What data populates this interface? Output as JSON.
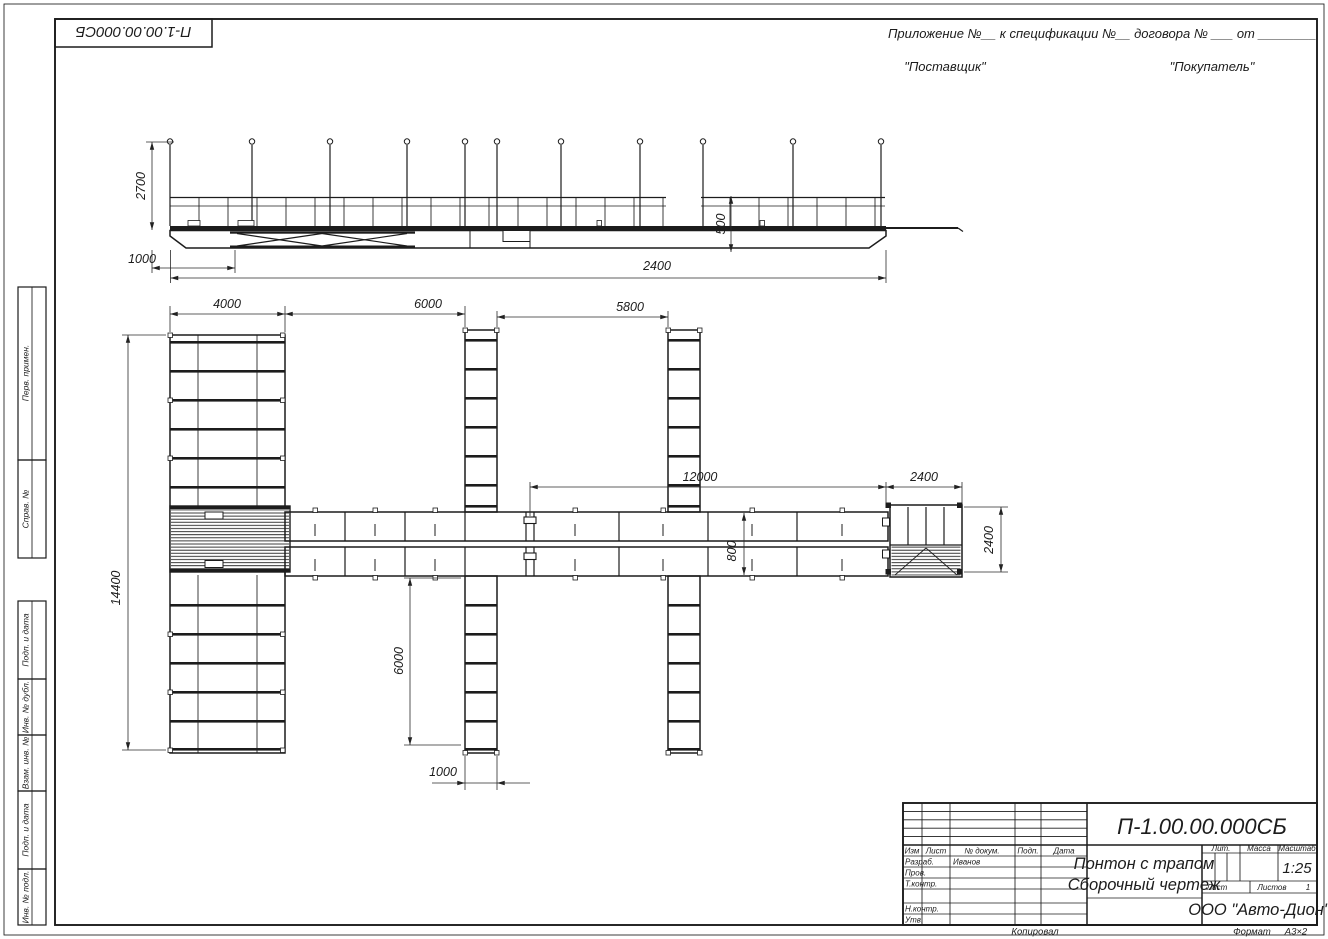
{
  "stamp_top_left": "П-1.00.00.000СБ",
  "header": {
    "line1": "Приложение №__      к спецификации №__    договора № ___  от  ________",
    "supplier": "\"Поставщик\"",
    "buyer": "\"Покупатель\""
  },
  "side_margin": {
    "boxes": [
      {
        "label": "Перв. примен."
      },
      {
        "label": "Справ. №"
      },
      {
        "label": "Подп. и дата"
      },
      {
        "label": "Инв. № дубл."
      },
      {
        "label": "Взам. инв. №"
      },
      {
        "label": "Подп. и дата"
      },
      {
        "label": "Инв. № подл."
      }
    ]
  },
  "dims": {
    "side": {
      "posts_height": "2700",
      "left_offset": "1000",
      "freeboard": "500",
      "total": "2400"
    },
    "plan": {
      "block_width": "4000",
      "gap1": "6000",
      "gap2": "5800",
      "walkway": "12000",
      "end_section": "2400",
      "total_length": "14400",
      "finger_length": "6000",
      "finger_width": "1000",
      "walkway_width": "800",
      "end_width": "2400"
    }
  },
  "title_block": {
    "designation": "П-1.00.00.000СБ",
    "name_line1": "Понтон с трапом",
    "name_line2": "Сборочный чертеж",
    "col_izm": "Изм",
    "col_list": "Лист",
    "col_doc": "№ докум.",
    "col_podp": "Подп.",
    "col_data": "Дата",
    "rows": [
      {
        "label": "Разраб.",
        "value": "Иванов"
      },
      {
        "label": "Пров.",
        "value": ""
      },
      {
        "label": "Т.контр.",
        "value": ""
      },
      {
        "label": "Н.контр.",
        "value": ""
      },
      {
        "label": "Утв.",
        "value": ""
      }
    ],
    "lit_label": "Лит.",
    "mass_label": "Масса",
    "scale_label": "Масштаб",
    "scale_value": "1:25",
    "sheet_label": "Лист",
    "sheets_label": "Листов",
    "sheets_value": "1",
    "company": "ООО \"Авто-Дион\""
  },
  "footer": {
    "copied": "Копировал",
    "format_label": "Формат",
    "format_value": "А3×2"
  }
}
